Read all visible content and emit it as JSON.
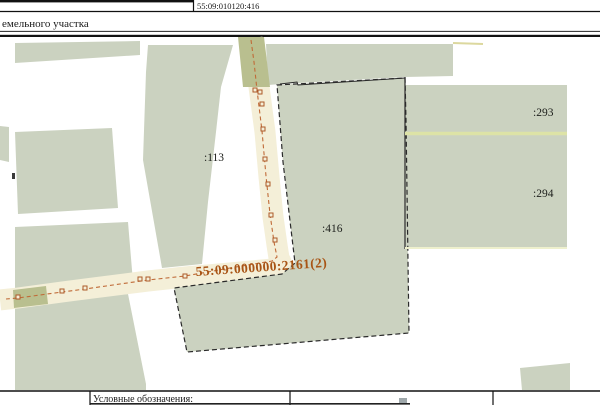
{
  "header": {
    "cadastral_number_top": "55:09:010120:416",
    "subtitle_partial": "емельного участка"
  },
  "map": {
    "parcel_labels": {
      "p113": ":113",
      "p416": ":416",
      "p293": ":293",
      "p294": ":294"
    },
    "linear_object_label": "55:09:000000:2161(2)",
    "colors": {
      "parcel_fill": "#cbd2c0",
      "road_fill": "#f4efd8",
      "overlap_fill": "#b9bf8f",
      "boundary_black": "#2a2a2a",
      "route_line_orange": "#c06b38",
      "route_marker_orange": "#ad5a28",
      "route_label_orange": "#a85415",
      "divider_yellow": "#dde3a6",
      "edge_yellow": "#eef0cd",
      "sliver_yellow": "#dcd89e"
    }
  },
  "legend": {
    "title": "Условные обозначения:"
  }
}
